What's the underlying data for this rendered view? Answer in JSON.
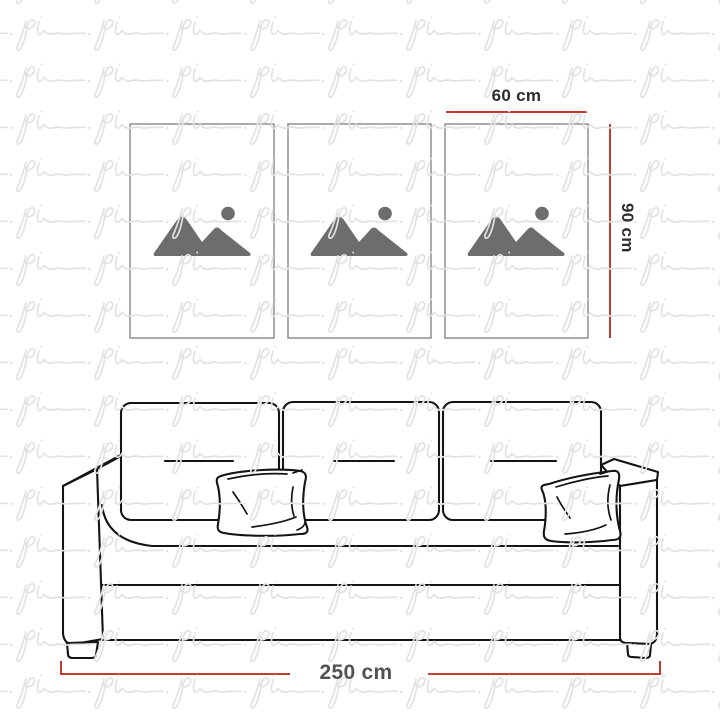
{
  "watermark": {
    "text": "pi"
  },
  "measurements": {
    "panel_width": "60 cm",
    "panel_height": "90 cm",
    "sofa_width": "250 cm"
  },
  "artwork": {
    "panel_count": 3,
    "panels": [
      {
        "name": "panel-1",
        "icon": "image-placeholder-icon"
      },
      {
        "name": "panel-2",
        "icon": "image-placeholder-icon"
      },
      {
        "name": "panel-3",
        "icon": "image-placeholder-icon"
      }
    ]
  },
  "colors": {
    "background": "#ffffff",
    "measurement_line": "#c43b32",
    "panel_width_label": "#2d2c2e",
    "panel_height_label": "#2d2c2e",
    "sofa_width_label": "#515254",
    "sofa_outline": "#141414",
    "frame_border": "#8f8f8f",
    "placeholder_icon": "#6d6d6d",
    "watermark": "#e2e2e2"
  }
}
